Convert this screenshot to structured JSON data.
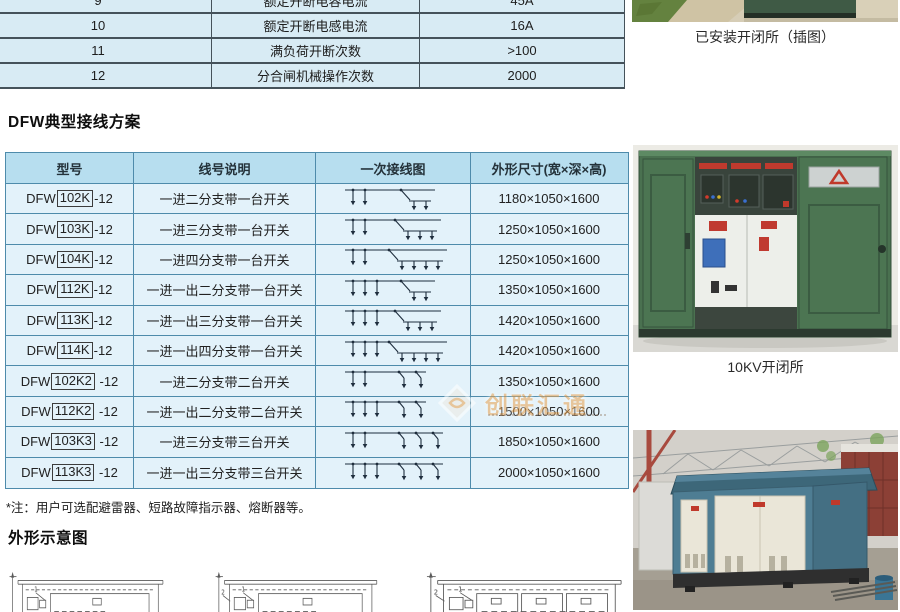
{
  "colors": {
    "table_header_bg": "#b7deef",
    "table_row_bg": "#e3f2fa",
    "table_border": "#4e8bab",
    "top_table_bg": "#d8ebf4",
    "top_table_border": "#45525a",
    "accent_red": "#c0392b",
    "watermark_orange": "#e9a24f",
    "cabinet_green": "#4c7552",
    "box_substation_teal": "#4e7d93"
  },
  "spec_table": {
    "rows": [
      {
        "no": "9",
        "name": "额定开断电容电流",
        "value": "45A"
      },
      {
        "no": "10",
        "name": "额定开断电感电流",
        "value": "16A"
      },
      {
        "no": "11",
        "name": "满负荷开断次数",
        "value": ">100"
      },
      {
        "no": "12",
        "name": "分合闸机械操作次数",
        "value": "2000"
      }
    ]
  },
  "section_wiring": {
    "title": "DFW典型接线方案"
  },
  "main_table": {
    "headers": [
      "型号",
      "线号说明",
      "一次接线图",
      "外形尺寸(宽×深×高)"
    ],
    "rows": [
      {
        "model_prefix": "DFW",
        "model_code": "102K",
        "model_suffix": "-12",
        "desc": "一进二分支带一台开关",
        "dim": "1180×1050×1600",
        "diagram": {
          "f": 2,
          "s": 1,
          "b": 2
        }
      },
      {
        "model_prefix": "DFW",
        "model_code": "103K",
        "model_suffix": "-12",
        "desc": "一进三分支带一台开关",
        "dim": "1250×1050×1600",
        "diagram": {
          "f": 2,
          "s": 1,
          "b": 3
        }
      },
      {
        "model_prefix": "DFW",
        "model_code": "104K",
        "model_suffix": "-12",
        "desc": "一进四分支带一台开关",
        "dim": "1250×1050×1600",
        "diagram": {
          "f": 2,
          "s": 1,
          "b": 4
        }
      },
      {
        "model_prefix": "DFW",
        "model_code": "112K",
        "model_suffix": "-12",
        "desc": "一进一出二分支带一台开关",
        "dim": "1350×1050×1600",
        "diagram": {
          "f": 3,
          "s": 1,
          "b": 2
        }
      },
      {
        "model_prefix": "DFW",
        "model_code": "113K",
        "model_suffix": "-12",
        "desc": "一进一出三分支带一台开关",
        "dim": "1420×1050×1600",
        "diagram": {
          "f": 3,
          "s": 1,
          "b": 3
        }
      },
      {
        "model_prefix": "DFW",
        "model_code": "114K",
        "model_suffix": "-12",
        "desc": "一进一出四分支带一台开关",
        "dim": "1420×1050×1600",
        "diagram": {
          "f": 3,
          "s": 1,
          "b": 4
        }
      },
      {
        "model_prefix": "DFW",
        "model_code": "102K2",
        "model_suffix": " -12",
        "desc": "一进二分支带二台开关",
        "dim": "1350×1050×1600",
        "diagram": {
          "f": 2,
          "s": 2,
          "b": 0
        }
      },
      {
        "model_prefix": "DFW",
        "model_code": "112K2",
        "model_suffix": " -12",
        "desc": "一进一出二分支带二台开关",
        "dim": "1500×1050×1600",
        "diagram": {
          "f": 3,
          "s": 2,
          "b": 0
        }
      },
      {
        "model_prefix": "DFW",
        "model_code": "103K3",
        "model_suffix": " -12",
        "desc": "一进三分支带三台开关",
        "dim": "1850×1050×1600",
        "diagram": {
          "f": 2,
          "s": 3,
          "b": 0
        }
      },
      {
        "model_prefix": "DFW",
        "model_code": "113K3",
        "model_suffix": " -12",
        "desc": "一进一出三分支带三台开关",
        "dim": "2000×1050×1600",
        "diagram": {
          "f": 3,
          "s": 3,
          "b": 0
        }
      }
    ]
  },
  "note": "*注：用户可选配避雷器、短路故障指示器、熔断器等。",
  "section_outline": {
    "title": "外形示意图"
  },
  "outline_drawings": [
    {
      "boxes": 1,
      "label2": false
    },
    {
      "boxes": 1,
      "label2": true
    },
    {
      "boxes": 3,
      "label2": true
    }
  ],
  "photos": {
    "top_caption": "已安装开闭所（插图）",
    "mid_caption": "10KV开闭所"
  },
  "watermark": {
    "text": "创联汇通"
  }
}
